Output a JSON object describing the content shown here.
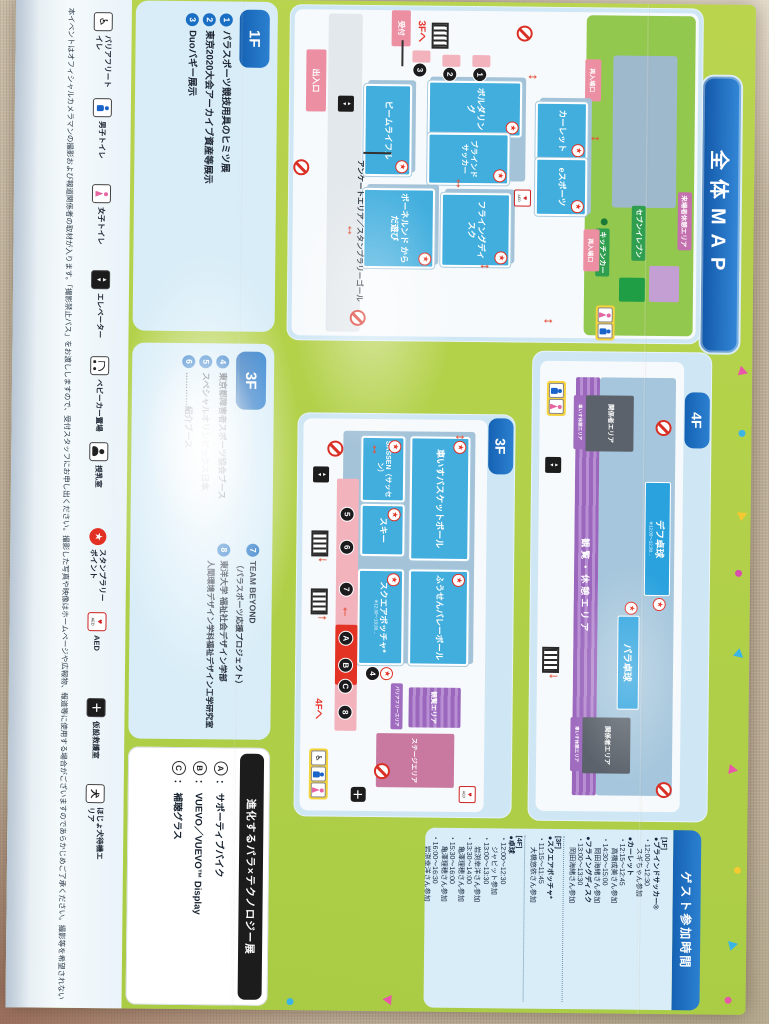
{
  "title": "全体MAP",
  "colors": {
    "accent_blue": "#1a6fc4",
    "pamphlet_green": "#b7d348",
    "panel_blue": "#cfe7f5",
    "room_blue": "#41aede",
    "tag_pink": "#ec8fa3",
    "marker_black": "#1b1b1e",
    "stamp_red": "#e23023"
  },
  "maps": {
    "f1": {
      "label": "1F",
      "rooms": {
        "bouldering": "ボルダリング",
        "blind_soccer": "ブラインドサッカー",
        "beam_rifle": "ビームライフル",
        "flying_disc": "フライングディスク",
        "bornelund": "ボーネルンド からだ遊び",
        "carlet": "カーレット",
        "esports": "eスポーツ"
      },
      "tags": {
        "reception": "受付",
        "entrance": "出入口",
        "to_3f": "3Fへ",
        "reentry": "再入場口",
        "kitchen_car": "キッチンカー",
        "seven_eleven": "セブンイレブン",
        "visitor_rest": "来場者休憩エリア",
        "survey": "アンケートエリア／スタンプラリーゴール"
      }
    },
    "f3": {
      "label": "3F",
      "rooms": {
        "wheelchair_basketball": "車いすバスケットボール",
        "sassen": "SASSEN（サッセン）",
        "ski": "スキー",
        "balloon_volleyball": "ふうせんバレーボール",
        "square_boccia": "スクエアボッチャ*",
        "square_boccia_note": "※12:30～13:30…",
        "viewing": "観覧エリア",
        "barrier_free": "バリアフリーエリア",
        "stage": "ステージエリア"
      },
      "tags": {
        "to_4f": "4Fへ"
      }
    },
    "f4": {
      "label": "4F",
      "areas": {
        "deaf_tt": "デフ卓球",
        "deaf_tt_note": "※12:00～12:30…",
        "para_tt": "パラ卓球",
        "viewing_rest": "観覧・休憩エリア",
        "staff": "関係者エリア",
        "wheelchair_rest": "車いす休憩エリア"
      }
    },
    "markers": {
      "n1": "1",
      "n2": "2",
      "n3": "3",
      "n4": "4",
      "n5": "5",
      "n6": "6",
      "n7": "7",
      "n8": "8",
      "a": "A",
      "b": "B",
      "c": "C"
    }
  },
  "lists": {
    "f1": {
      "label": "1F",
      "items": [
        {
          "num": "1",
          "text": "パラスポーツ競技用具のヒミツ展"
        },
        {
          "num": "2",
          "text": "東京2020大会アーカイブ資産等展示"
        },
        {
          "num": "3",
          "text": "Duoバギー展示"
        }
      ]
    },
    "f3": {
      "label": "3F",
      "col1": [
        {
          "num": "4",
          "text": "東京都障害者スポーツ協会ブース"
        },
        {
          "num": "5",
          "text": "スペシャルオリンピックス日本"
        },
        {
          "num": "6",
          "text": "…………紹介ブース"
        }
      ],
      "col2": [
        {
          "num": "7",
          "text": "TEAM BEYOND",
          "sub": "（パラスポーツ応援プロジェクト）"
        },
        {
          "num": "8",
          "text": "東洋大学 福祉社会デザイン学部",
          "sub": "人間環境デザイン学科福祉デザイン工学研究室"
        }
      ]
    },
    "tech": {
      "title": "進化するパラ×テクノロジー展",
      "items": [
        {
          "letter": "A",
          "text": "サポーティブバイク"
        },
        {
          "letter": "B",
          "text": "VUEVO／VUEVO™ Display"
        },
        {
          "letter": "C",
          "text": "補聴グラス"
        }
      ]
    }
  },
  "schedule": {
    "title": "ゲスト参加時間",
    "lines": [
      "[1F]",
      "●ブラインドサッカー®",
      "・12:00～12:30",
      "スギちゃん参加",
      "●カーレット",
      "・12:15～12:45",
      "高橋成美さん参加",
      "・14:30～15:00",
      "岡田海緒さん参加",
      "●フライングディスク",
      "・13:00～13:30",
      "岡田海緒さん参加",
      "[3F]",
      "●スクエアボッチャ*",
      "・11:15～11:45",
      "大橋悠依さん参加",
      "[4F]",
      "●卓球",
      "・12:00～12:30",
      "ジャビット参加",
      "・13:00～13:30",
      "岩渕幸洋さん参加",
      "・13:30～14:00",
      "亀澤理穂さん参加",
      "・15:30～16:00",
      "亀澤理穂さん参加",
      "・16:00～16:30",
      "岩渕幸洋さん参加"
    ]
  },
  "legend": {
    "items": [
      {
        "icon": "wheelchair-icon",
        "label": "バリアフリートイレ"
      },
      {
        "icon": "male-toilet-icon",
        "label": "男子トイレ"
      },
      {
        "icon": "female-toilet-icon",
        "label": "女子トイレ"
      },
      {
        "icon": "elevator-icon",
        "label": "エレベーター"
      },
      {
        "icon": "stroller-icon",
        "label": "ベビーカー置場"
      },
      {
        "icon": "nursing-room-icon",
        "label": "授乳室"
      },
      {
        "icon": "stamp-rally-icon",
        "label": "スタンプラリーポイント"
      },
      {
        "icon": "aed-icon",
        "label": "AED"
      },
      {
        "icon": "first-aid-icon",
        "label": "仮設救護室"
      },
      {
        "icon": "assistance-dog-icon",
        "label": "ほじょ犬待機エリア"
      }
    ]
  },
  "notice": "本イベントはオフィシャルカメラマンの撮影および報道関係者の取材が入ります。「撮影禁止パス」をお渡ししますので、受付スタッフにお申し出ください。撮影した写真や映像はホームページや広報物、報道等に使用する場合がございますのであらかじめご了承ください。撮影等を希望されない方は"
}
